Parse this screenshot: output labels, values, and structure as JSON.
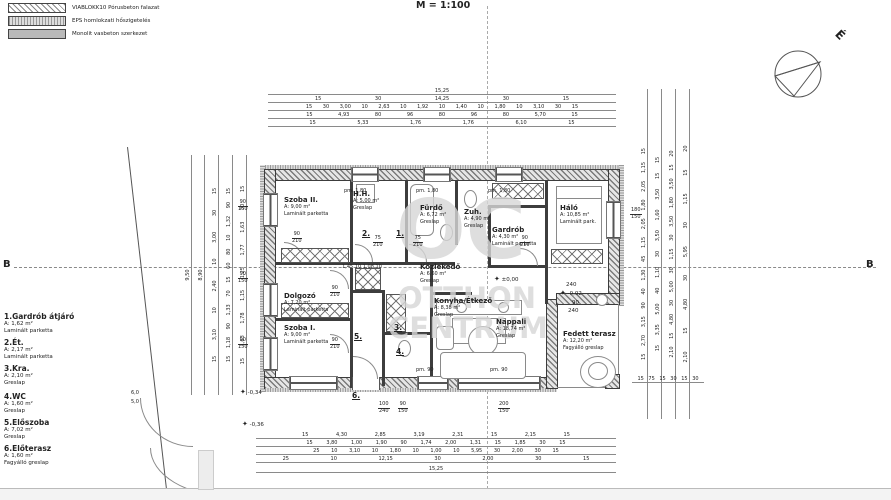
{
  "scale": "M = 1:100",
  "north": "É",
  "section": "B",
  "legend": {
    "item1": "VIABLOKK10 Pórusbeton falazat",
    "item2": "EPS homlokzati hőszigetelés",
    "item3": "Monolit vasbeton szerkezet"
  },
  "room_list": {
    "r1": {
      "name": "1.Gardrób átjáró",
      "area": "A: 1,62 m²",
      "floor": "Laminált parketta"
    },
    "r2": {
      "name": "2.Ét.",
      "area": "A: 2,17 m²",
      "floor": "Laminált parketta"
    },
    "r3": {
      "name": "3.Kra.",
      "area": "A: 2,10 m²",
      "floor": "Greslap"
    },
    "r4": {
      "name": "4.WC",
      "area": "A: 1,60 m²",
      "floor": "Greslap"
    },
    "r5": {
      "name": "5.Előszoba",
      "area": "A: 7,02 m²",
      "floor": "Greslap"
    },
    "r6": {
      "name": "6.Előterasz",
      "area": "A: 1,60 m²",
      "floor": "Fagyálló greslap"
    }
  },
  "rooms": {
    "szoba2": {
      "name": "Szoba II.",
      "area": "A: 9,00 m²",
      "floor": "Laminált parketta"
    },
    "hh": {
      "name": "H.H.",
      "area": "A: 5,00 m²",
      "floor": "Greslap"
    },
    "furdo": {
      "name": "Fürdő",
      "area": "A: 6,72 m²",
      "floor": "Greslap"
    },
    "zuh": {
      "name": "Zuh.",
      "area": "A: 4,90 m²",
      "floor": "Greslap"
    },
    "gardrob": {
      "name": "Gardrób",
      "area": "A: 4,30 m²",
      "floor": "Laminált parketta"
    },
    "halo": {
      "name": "Háló",
      "area": "A: 10,85 m²",
      "floor": "Laminált park."
    },
    "dolgozo": {
      "name": "Dolgozó",
      "area": "A: 7,20 m²",
      "floor": "Laminált parketta"
    },
    "szoba1": {
      "name": "Szoba I.",
      "area": "A: 9,00 m²",
      "floor": "Laminált parketta"
    },
    "kozlekedo": {
      "name": "Közlekedő",
      "area": "A: 6,60 m²",
      "floor": "Greslap"
    },
    "konyha": {
      "name": "Konyha/Étkező",
      "area": "A: 8,38 m²",
      "floor": "Greslap"
    },
    "nappali": {
      "name": "Nappali",
      "area": "A: 18,74 m²",
      "floor": "Greslap"
    },
    "terasz": {
      "name": "Fedett terasz",
      "area": "A: 12,20 m²",
      "floor": "Fagyálló greslap"
    }
  },
  "markers": {
    "m1": "1.",
    "m2": "2.",
    "m3": "3.",
    "m4": "4.",
    "m5": "5.",
    "m6": "6."
  },
  "levels": {
    "zero": "±0,00",
    "m002": "-0,02",
    "m034": "-0,34",
    "m036": "-0,36"
  },
  "icons": {
    "level": "✦"
  },
  "labels": {
    "pm180": "pm. 1,80",
    "pm90": "pm. 90",
    "innerchain": "1,45  10  1,08  10",
    "lintel": "240",
    "gate1": "6,0",
    "gate2": "5,0"
  },
  "stacks": {
    "n90": "90",
    "n150": "150",
    "n180": "180",
    "n200": "200",
    "n210": "210",
    "n75": "75",
    "n100": "100",
    "n240": "240"
  },
  "dims": {
    "top": {
      "r1": "15,25",
      "r2": "15 30 14,25 30 15",
      "r3": "15 30 3,00 10 2,63 10 1,92 10 1,40 10 1,80 10 3,10 30 15",
      "r4": "15 4,93 80 96 80 96 80 5,70 15",
      "r5": "15 5,33 1,76 1,76 6,10 15"
    },
    "bottom": {
      "r1": "15 4,30 2,85 3,19 2,31 15 2,15 15",
      "r2": "15 3,80 1,00 1,90 90 1,74 2,00 1,31 15 1,85 30 15",
      "r3": "25 10 3,10 10 1,80 10 1,00 10 5,95 30 2,00 30 15",
      "r4": "25 10 12,15 30 2,00 30 15",
      "r5": "15,25"
    },
    "left": {
      "c1": "9,50",
      "c2": "8,90",
      "c3": "15 3,10 10 2,40 10 3,00 30 15",
      "c4": "15 1,18 90 1,33 70 15 60 80 10 1,32 90 15",
      "c5": "15 1,63 1,78 1,15 1,25 1,77 1,63 30 15"
    },
    "right": {
      "c1": "15 2,70 3,15 90 40 1,30 45 1,15 2,05 1,80 2,05 1,15 15",
      "c2": "15 3,35 5,00 40 1,10 30 3,50 1,60 3,50 15 15",
      "c3": "2,10 15 4,80 30 5,00 30 1,15 30 3,50 1,80 3,50 15 20",
      "c4": "2,10 15 4,80 30 5,95 30 1,15 15 20"
    },
    "right_small": "15 75 15 30 15 30"
  },
  "watermark": {
    "logo": "OC",
    "line1": "OTTHON",
    "line2": "CENTRUM"
  }
}
